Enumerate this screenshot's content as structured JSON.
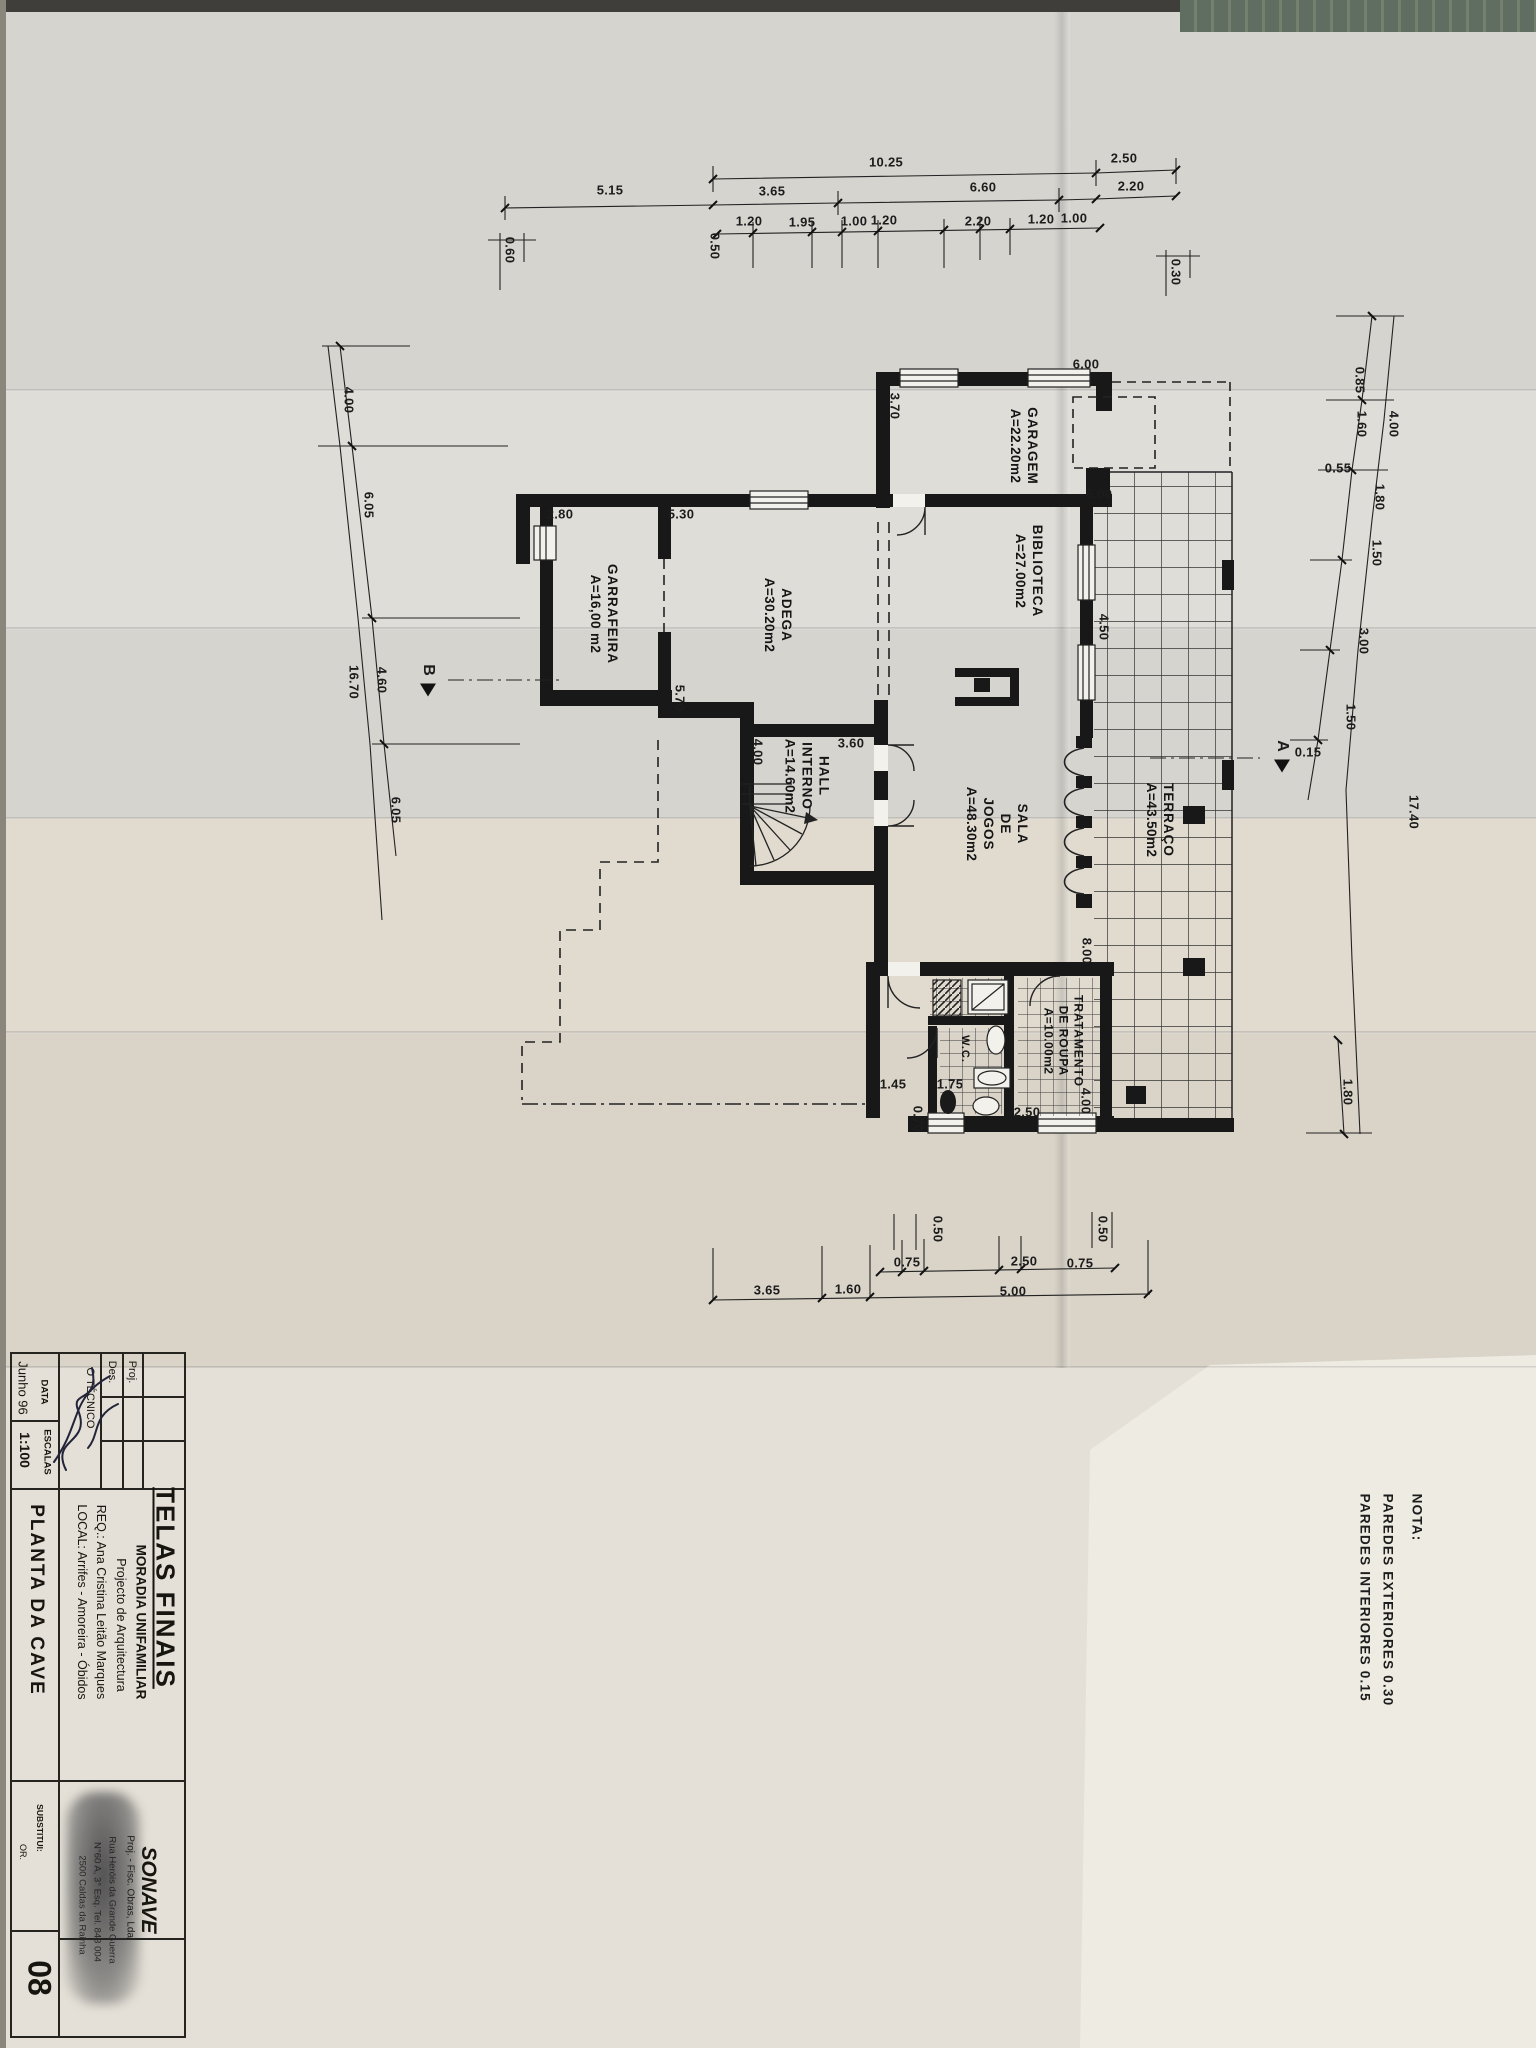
{
  "dims": [
    "10.25",
    "2.50",
    "5.15",
    "3.65",
    "6.60",
    "2.20",
    "0.50",
    "1.20",
    "1.95",
    "1.00",
    "1.20",
    "2.20",
    "1.20",
    "1.00",
    "0.30",
    "0.60",
    "4.00",
    "6.05",
    "4.60",
    "16.70",
    "6.05",
    "0.85",
    "4.00",
    "1.60",
    "0.55",
    "1.80",
    "1.50",
    "3.00",
    "1.50",
    "0.15",
    "17.40",
    "1.80",
    "2.80",
    "5.30",
    "3.70",
    "6.00",
    "6.00",
    "4.50",
    "5.70",
    "3.60",
    "4.00",
    "8.00",
    "1.45",
    "1.75",
    "0.70",
    "2.50",
    "4.00",
    "0.50",
    "0.75",
    "2.50",
    "0.75",
    "0.50",
    "3.65",
    "1.60",
    "5.00"
  ],
  "rooms": {
    "garagem": {
      "name": "GARAGEM",
      "area": "A=22.20m2"
    },
    "biblioteca": {
      "name": "BIBLIOTECA",
      "area": "A=27.00m2"
    },
    "adega": {
      "name": "ADEGA",
      "area": "A=30.20m2"
    },
    "garrafeira": {
      "name": "GARRAFEIRA",
      "area": "A=16,00 m2"
    },
    "hall": {
      "name1": "HALL",
      "name2": "INTERNO",
      "area": "A=14.60m2"
    },
    "sala": {
      "name1": "SALA",
      "name2": "DE",
      "name3": "JOGOS",
      "area": "A=48.30m2"
    },
    "terraco": {
      "name": "TERRAÇO",
      "area": "A=43.50m2"
    },
    "tratamento": {
      "name1": "TRATAMENTO",
      "name2": "DE ROUPA",
      "area": "A=10.00m2"
    },
    "wc": {
      "name": "W.C."
    }
  },
  "sections": {
    "a": "A",
    "b": "B"
  },
  "note": {
    "heading": "NOTA:",
    "line1": "PAREDES  EXTERIORES  0.30",
    "line2": "PAREDES  INTERIORES  0.15"
  },
  "titleblock": {
    "proj_label": "Proj.",
    "des_label": "Des.",
    "tecnico_label": "O TÉCNICO",
    "data_label": "DATA",
    "data_value": "Junho 96",
    "escalas_label": "ESCALAS",
    "escalas_value": "1:100",
    "drawing_title": "PLANTA  DA  CAVE",
    "substitui_label": "SUBSTITUI:",
    "substitui_value": "OR.",
    "sheet_number": "08",
    "main_title": "TELAS FINAIS",
    "project_type": "MORADIA UNIFAMILIAR",
    "subtitle": "Projecto de Arquitectura",
    "req_line": "REQ.: Ana Cristina Leitão Marques",
    "local_line": "LOCAL: Arrifes - Amoreira - Óbidos",
    "company": "SONAVE",
    "company_sub": "Proj. - Fisc. Obras, Lda.",
    "company_addr1": "Rua Heróis da Grande Guerra",
    "company_addr2": "N°60 A, 3° Esq.  Tel. 843 004",
    "company_addr3": "2500 Caldas da Rainha"
  }
}
